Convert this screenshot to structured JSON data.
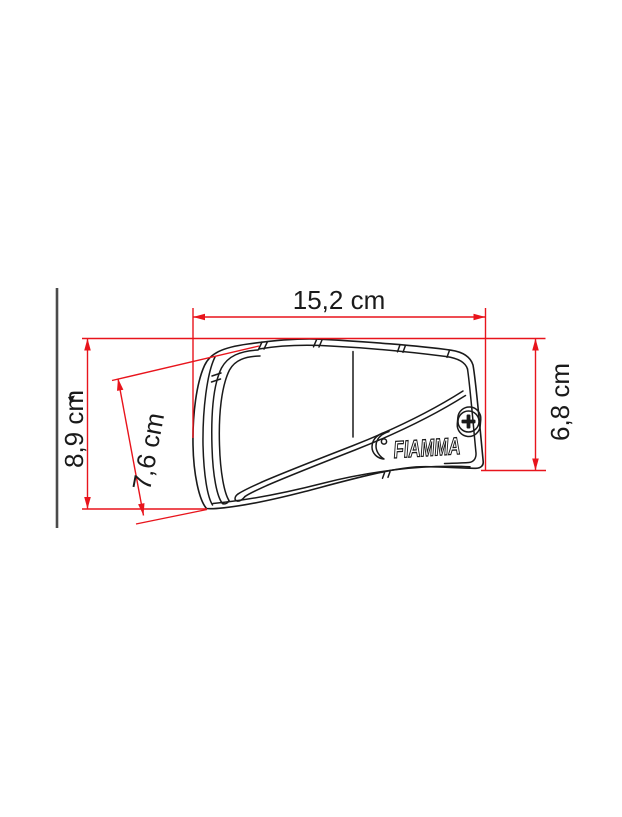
{
  "drawing": {
    "product_logo": "FIAMMA",
    "dimensions": {
      "width_top": {
        "label": "15,2 cm"
      },
      "height_left": {
        "label": "8,9 cm"
      },
      "depth_diagonal": {
        "label": "7,6 cm"
      },
      "height_right": {
        "label": "6,8 cm"
      }
    },
    "colors": {
      "dimension_red": "#e8141c",
      "line_black": "#1a1a1a",
      "wall_gray": "#4b4b4b",
      "background": "#ffffff"
    }
  }
}
